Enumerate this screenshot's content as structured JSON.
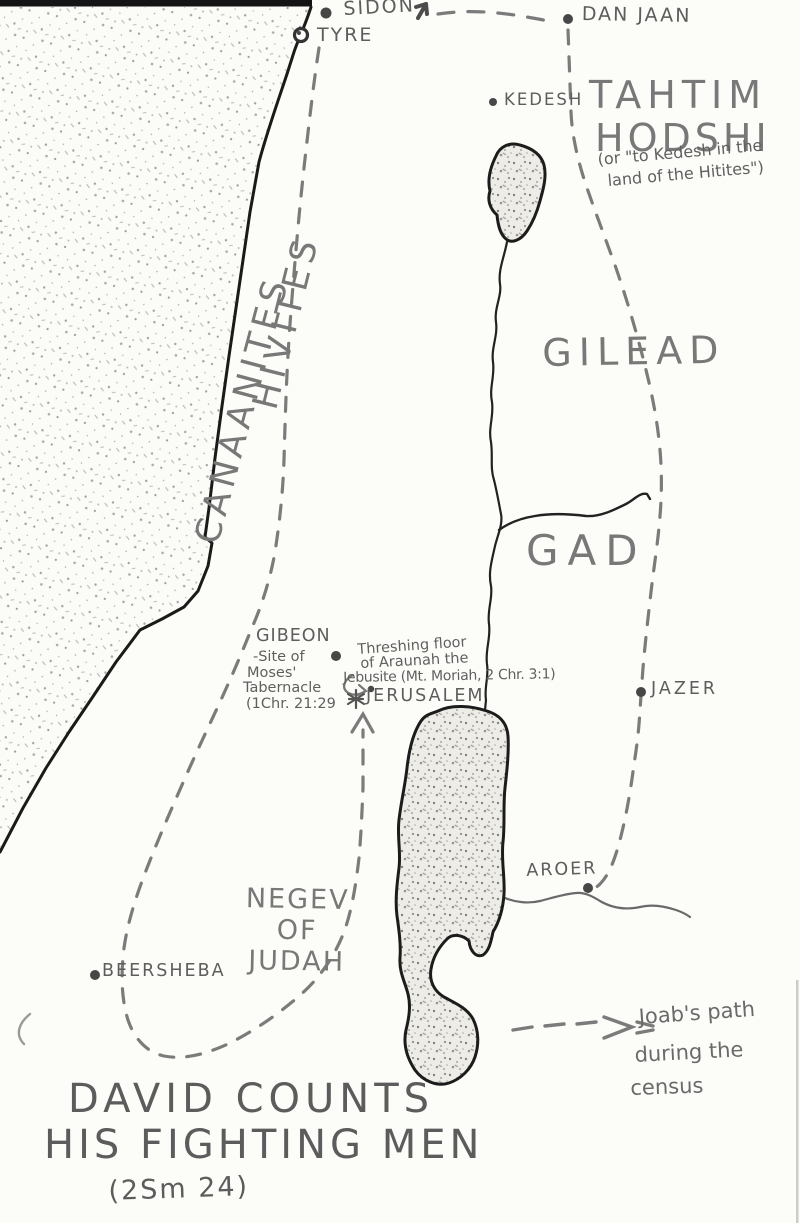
{
  "colors": {
    "pencil": "#6e6e6e",
    "ink": "#1b1b1b",
    "paper": "#fcfcf9"
  },
  "title": {
    "line1": "DAVID COUNTS",
    "line2": "HIS FIGHTING MEN",
    "line3": "(2Sm 24)"
  },
  "legend": {
    "line1": "Joab's path",
    "line2": "during the",
    "line3": "census"
  },
  "places": {
    "sidon": "SIDON",
    "tyre": "TYRE",
    "dan_jaan": "DAN JAAN",
    "kedesh": "KEDESH",
    "gibeon": "GIBEON",
    "jerusalem": "JERUSALEM",
    "jazer": "JAZER",
    "aroer": "AROER",
    "beersheba": "BEERSHEBA"
  },
  "regions": {
    "canaanites": "CANAANITES",
    "hivites": "HIVITES",
    "gilead": "GILEAD",
    "gad": "GAD",
    "tahtim_line1": "TAHTIM",
    "tahtim_line2": "HODSHI",
    "tahtim_note1": "(or \"to Kedesh in the",
    "tahtim_note2": "land of the Hitites\")",
    "negev_line1": "NEGEV",
    "negev_line2": "OF",
    "negev_line3": "JUDAH"
  },
  "notes": {
    "gibeon_line1": "-Site of",
    "gibeon_line2": "Moses'",
    "gibeon_line3": "Tabernacle",
    "gibeon_line4": "(1Chr. 21:29",
    "threshing_line1": "Threshing floor",
    "threshing_line2": "of Araunah the",
    "threshing_line3": "Jebusite (Mt. Moriah, 2 Chr. 3:1)"
  }
}
